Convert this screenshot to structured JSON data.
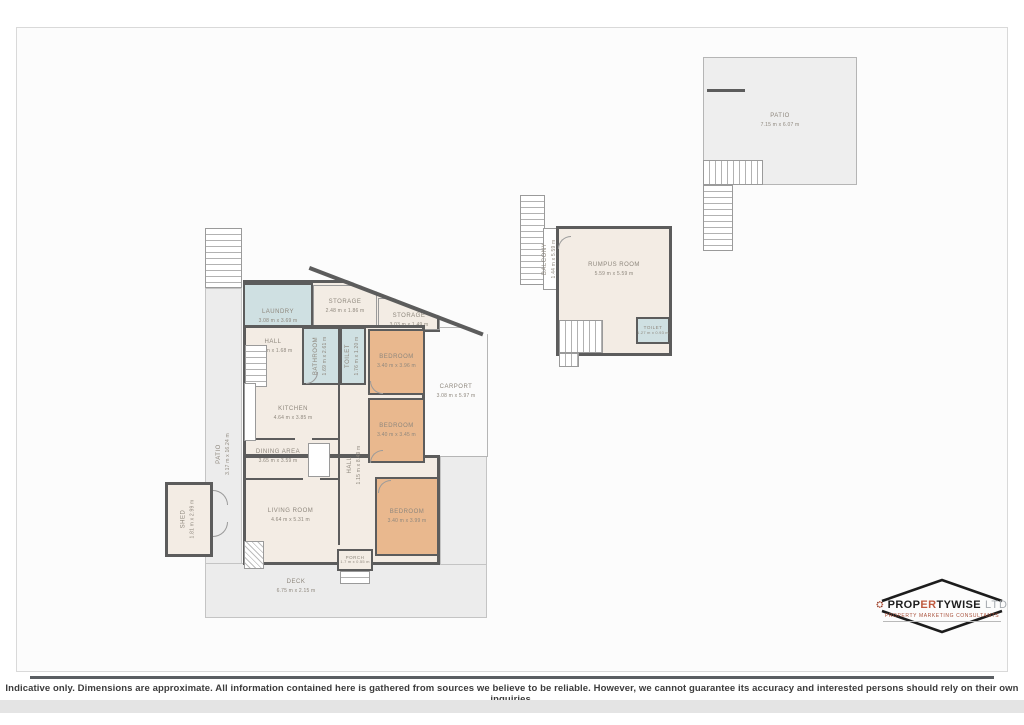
{
  "rooms": {
    "laundry": {
      "name": "LAUNDRY",
      "dims": "3.08 m x 3.69 m"
    },
    "storage1": {
      "name": "STORAGE",
      "dims": "2.48 m x 1.86 m"
    },
    "storage2": {
      "name": "STORAGE",
      "dims": "3.03 m x 1.49 m"
    },
    "hall1": {
      "name": "HALL",
      "dims": "3.89 m x 1.68 m"
    },
    "bathroom": {
      "name": "BATHROOM",
      "dims": "1.69 m x 2.61 m"
    },
    "toilet1": {
      "name": "TOILET",
      "dims": "1.76 m x 1.20 m"
    },
    "bedroom1": {
      "name": "BEDROOM",
      "dims": "3.40 m x 3.96 m"
    },
    "kitchen": {
      "name": "KITCHEN",
      "dims": "4.64 m x 3.85 m"
    },
    "dining": {
      "name": "DINING AREA",
      "dims": "3.65 m x 3.59 m"
    },
    "living": {
      "name": "LIVING ROOM",
      "dims": "4.64 m x 5.31 m"
    },
    "hall2": {
      "name": "HALL",
      "dims": "1.15 m x 8.49 m"
    },
    "bedroom2": {
      "name": "BEDROOM",
      "dims": "3.40 m x 3.45 m"
    },
    "bedroom3": {
      "name": "BEDROOM",
      "dims": "3.40 m x 3.99 m"
    },
    "porch": {
      "name": "PORCH",
      "dims": "1.7 m x 0.55 m"
    },
    "carport": {
      "name": "CARPORT",
      "dims": "3.08 m x 5.97 m"
    },
    "patio_side": {
      "name": "PATIO",
      "dims": "3.17 m x 16.24 m"
    },
    "shed": {
      "name": "SHED",
      "dims": "1.81 m x 2.99 m"
    },
    "deck": {
      "name": "DECK",
      "dims": "6.75 m x 2.15 m"
    },
    "rumpus": {
      "name": "RUMPUS ROOM",
      "dims": "5.59 m x 5.59 m"
    },
    "toilet2": {
      "name": "TOILET",
      "dims": "1.27 m x 0.93 m"
    },
    "balcony": {
      "name": "BALCONY",
      "dims": "1.44 m x 5.59 m"
    },
    "patio_top": {
      "name": "PATIO",
      "dims": "7.15 m x 6.07 m"
    }
  },
  "logo": {
    "brand_prefix": "PROP",
    "brand_accent": "ER",
    "brand_rest": "TYWISE",
    "suffix": "LTD",
    "tagline": "PROPERTY MARKETING CONSULTANTS"
  },
  "footer": {
    "disclaimer": "Indicative only. Dimensions are approximate. All information contained here is gathered from sources we believe to be reliable. However, we cannot guarantee its accuracy and interested persons should rely on their own inquiries."
  },
  "colors": {
    "wall": "#5c5c5c",
    "floor_fill": "#f3ece4",
    "bedroom_fill": "#e9b88e",
    "wet_area_fill": "#cfe0e2",
    "outdoor_fill": "#ececec",
    "logo_accent": "#c05a3e"
  }
}
